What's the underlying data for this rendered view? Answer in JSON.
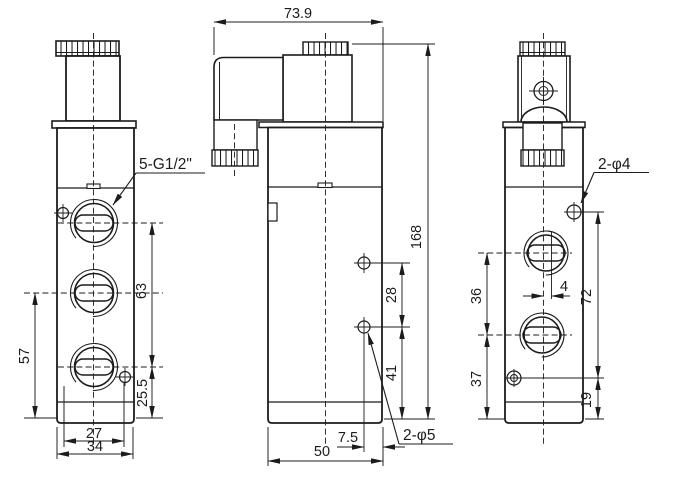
{
  "views": {
    "left": {
      "thread_label": "5-G1/2\"",
      "dim_port_pitch": "63",
      "dim_left_height": "57",
      "dim_bottom_offset": "25.5",
      "dim_screw_spacing": "27",
      "dim_body_width": "34"
    },
    "front": {
      "dim_overall_width": "73.9",
      "dim_overall_height": "168",
      "dim_hole_pitch": "28",
      "dim_hole_to_bottom": "41",
      "dim_hole_edge_offset": "7.5",
      "dim_body_width": "50",
      "hole_label": "2-φ5"
    },
    "right": {
      "hole_label": "2-φ4",
      "dim_port_pitch": "36",
      "dim_port_to_bottom": "37",
      "dim_port_offset": "4",
      "dim_hole_span": "72",
      "dim_screw_to_bottom": "19"
    }
  }
}
